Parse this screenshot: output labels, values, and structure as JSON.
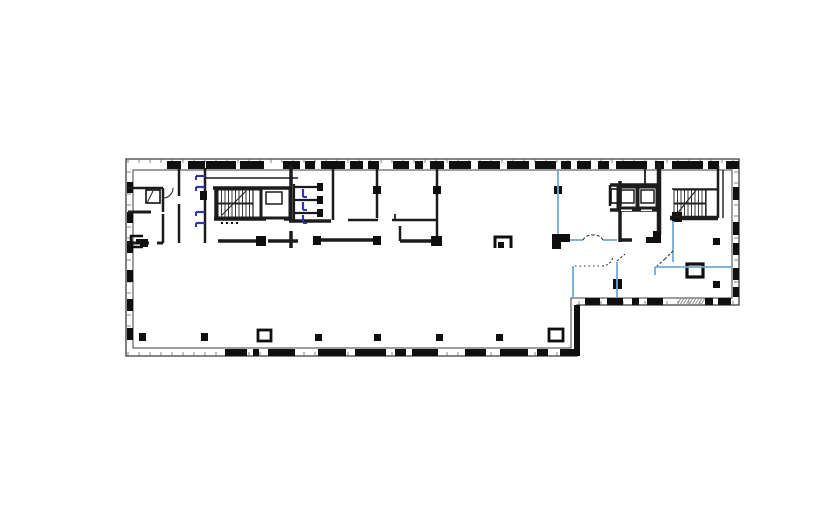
{
  "app": {
    "type": "cad-floor-plan-view",
    "visible_text": ""
  },
  "canvas": {
    "width": 821,
    "height": 528,
    "background": "#ffffff"
  },
  "colors": {
    "outline": "#3c3c3c",
    "wall": "#1c1c1c",
    "pier": "#0f0f0f",
    "tread": "#222222",
    "tick": "#666666",
    "hatch": "#8a8a8a",
    "partition_blue": "#74aad2",
    "door_blue": "#3434b2",
    "dash": "#333333",
    "white": "#ffffff"
  },
  "plan": {
    "perimeter": {
      "outer": "126,159 739,159 739,305 577,305 577,356 126,356",
      "inner": "133,170 732,170 732,298 571,298 571,348 133,348"
    },
    "step_wall": [
      574,
      305,
      6,
      51
    ],
    "wall_piers": {
      "top": {
        "y": 161,
        "h": 8,
        "spans": [
          [
            167,
            181
          ],
          [
            188,
            205
          ],
          [
            206,
            236
          ],
          [
            240,
            264
          ],
          [
            283,
            300
          ],
          [
            305,
            315
          ],
          [
            321,
            345
          ],
          [
            350,
            363
          ],
          [
            368,
            379
          ],
          [
            393,
            409
          ],
          [
            415,
            423
          ],
          [
            430,
            444
          ],
          [
            449,
            471
          ],
          [
            478,
            500
          ],
          [
            507,
            529
          ],
          [
            535,
            556
          ],
          [
            561,
            571
          ],
          [
            577,
            591
          ],
          [
            598,
            609
          ],
          [
            616,
            647
          ],
          [
            655,
            664
          ],
          [
            672,
            703
          ],
          [
            708,
            719
          ],
          [
            726,
            739
          ]
        ]
      },
      "bottom_left": {
        "y": 349,
        "h": 7,
        "spans": [
          [
            225,
            247
          ],
          [
            253,
            259
          ],
          [
            268,
            295
          ],
          [
            318,
            346
          ],
          [
            355,
            386
          ],
          [
            395,
            406
          ],
          [
            412,
            438
          ],
          [
            465,
            486
          ],
          [
            500,
            528
          ],
          [
            537,
            548
          ],
          [
            560,
            577
          ]
        ]
      },
      "bottom_right": {
        "y": 298,
        "h": 7,
        "spans": [
          [
            585,
            600
          ],
          [
            607,
            623
          ],
          [
            632,
            639
          ],
          [
            647,
            663
          ],
          [
            705,
            713
          ],
          [
            718,
            731
          ]
        ]
      },
      "left": {
        "x": 127,
        "w": 6,
        "spans": [
          [
            182,
            193
          ],
          [
            212,
            223
          ],
          [
            241,
            253
          ],
          [
            270,
            282
          ],
          [
            299,
            311
          ],
          [
            328,
            340
          ]
        ]
      },
      "right": {
        "x": 733,
        "w": 6,
        "spans": [
          [
            187,
            200
          ],
          [
            222,
            235
          ],
          [
            243,
            255
          ],
          [
            268,
            280
          ],
          [
            287,
            297
          ]
        ]
      }
    },
    "hatch_strip": {
      "x1": 677,
      "x2": 702,
      "y": 298,
      "h": 7
    },
    "walls": [
      [
        128,
        188,
        163,
        188,
        2.5
      ],
      [
        163,
        188,
        163,
        212,
        2.5
      ],
      [
        128,
        212,
        151,
        212,
        3
      ],
      [
        128,
        243,
        149,
        243,
        3
      ],
      [
        157,
        243,
        163,
        243,
        3
      ],
      [
        163,
        214,
        163,
        243,
        2.5
      ],
      [
        179,
        168,
        179,
        196,
        2.5
      ],
      [
        179,
        204,
        179,
        243,
        2.5
      ],
      [
        205,
        168,
        205,
        191,
        2.5
      ],
      [
        205,
        200,
        205,
        243,
        2.5
      ],
      [
        205,
        178,
        298,
        178,
        1.6
      ],
      [
        213,
        188,
        292,
        188,
        3.5
      ],
      [
        216,
        188,
        216,
        220,
        3.5
      ],
      [
        214,
        219,
        292,
        219,
        3.5
      ],
      [
        291,
        166,
        291,
        222,
        3.5
      ],
      [
        291,
        231,
        291,
        248,
        3.5
      ],
      [
        294,
        187,
        317,
        187,
        2.2
      ],
      [
        294,
        200,
        317,
        200,
        2.2
      ],
      [
        294,
        213,
        317,
        213,
        2.2
      ],
      [
        294,
        184,
        294,
        221,
        2.2
      ],
      [
        289,
        221,
        331,
        221,
        3.5
      ],
      [
        333,
        169,
        333,
        220,
        2.5
      ],
      [
        377,
        169,
        377,
        218,
        2.5
      ],
      [
        437,
        169,
        437,
        243,
        2.5
      ],
      [
        348,
        220,
        378,
        220,
        2.5
      ],
      [
        392,
        220,
        437,
        220,
        2.5
      ],
      [
        395,
        214,
        395,
        220,
        1.8
      ],
      [
        400,
        226,
        400,
        241,
        2.5
      ],
      [
        400,
        241,
        434,
        241,
        3.5
      ],
      [
        218,
        241,
        257,
        241,
        3.5
      ],
      [
        268,
        241,
        298,
        241,
        3.5
      ],
      [
        318,
        240,
        377,
        240,
        3.5
      ],
      [
        620,
        181,
        620,
        242,
        3.5
      ],
      [
        620,
        240,
        632,
        240,
        3.5
      ],
      [
        610,
        185,
        658,
        185,
        3.5
      ],
      [
        610,
        185,
        610,
        206,
        2.5
      ],
      [
        610,
        210,
        658,
        210,
        3.5
      ],
      [
        659,
        163,
        659,
        235,
        4.5
      ],
      [
        672,
        189,
        718,
        189,
        1.6
      ],
      [
        670,
        218,
        718,
        218,
        4.5
      ],
      [
        718,
        166,
        718,
        218,
        2.5
      ],
      [
        723,
        170,
        723,
        218,
        1.4
      ],
      [
        645,
        166,
        645,
        185,
        1.8
      ]
    ],
    "white_gaps": [
      [
        266,
        215,
        18,
        6
      ],
      [
        621,
        206,
        11,
        5
      ],
      [
        641,
        206,
        11,
        5
      ]
    ],
    "fills": [
      [
        200,
        191,
        7,
        9
      ],
      [
        317,
        183,
        6,
        8
      ],
      [
        317,
        196,
        6,
        8
      ],
      [
        317,
        209,
        6,
        8
      ],
      [
        373,
        186,
        8,
        8
      ],
      [
        433,
        186,
        8,
        8
      ],
      [
        431,
        236,
        11,
        10
      ],
      [
        554,
        186,
        8,
        8
      ],
      [
        256,
        236,
        10,
        10
      ],
      [
        313,
        236,
        8,
        9
      ],
      [
        373,
        236,
        8,
        9
      ],
      [
        552,
        234,
        18,
        8
      ],
      [
        552,
        242,
        9,
        7
      ],
      [
        653,
        231,
        8,
        12
      ],
      [
        646,
        237,
        8,
        6
      ],
      [
        672,
        212,
        10,
        10
      ],
      [
        613,
        279,
        9,
        10
      ],
      [
        140,
        239,
        8,
        8
      ],
      [
        139,
        333,
        7,
        8
      ],
      [
        201,
        333,
        7,
        8
      ],
      [
        315,
        334,
        7,
        7
      ],
      [
        374,
        334,
        7,
        7
      ],
      [
        436,
        334,
        7,
        7
      ],
      [
        496,
        334,
        7,
        7
      ],
      [
        713,
        238,
        7,
        7
      ],
      [
        713,
        281,
        7,
        7
      ]
    ],
    "hollow_rects": [
      {
        "r": [
          258,
          330,
          13,
          11
        ],
        "w": 2.8,
        "name": "column-wide-1"
      },
      {
        "r": [
          549,
          329,
          14,
          12
        ],
        "w": 2.8,
        "name": "column-wide-2"
      },
      {
        "r": [
          687,
          264,
          16,
          13
        ],
        "w": 3.2,
        "name": "shaft-box"
      },
      {
        "r": [
          146,
          190,
          14,
          13
        ],
        "w": 1.6,
        "name": "closet-box"
      },
      {
        "r": [
          611,
          189,
          7,
          14
        ],
        "w": 1.6,
        "name": "elevator-alcove-fixture"
      }
    ],
    "stroke_paths": [
      {
        "d": "M495,248 V237 H511 V248",
        "w": 3,
        "name": "column-bracket"
      },
      {
        "d": "M143,236 H131 V247 H143",
        "w": 2.5,
        "name": "fixture-bracket"
      }
    ],
    "bracket_fills": [
      [
        498,
        242,
        6,
        6
      ],
      [
        136,
        239,
        6,
        5
      ]
    ],
    "stairs": [
      {
        "x": 218,
        "y": 190,
        "w": 43,
        "h": 27,
        "landingW": 8,
        "step": 3.5,
        "diag": [
          222,
          215,
          246,
          191
        ],
        "name": "stair-left"
      },
      {
        "x": 674,
        "y": 190,
        "w": 44,
        "h": 27,
        "landingW": 12,
        "step": 3.5,
        "diag": [
          676,
          215,
          697,
          189
        ],
        "name": "stair-right"
      }
    ],
    "elevators": [
      {
        "shaft": [
          261,
          188,
          29,
          30
        ],
        "car": [
          266,
          192,
          16,
          12
        ],
        "name": "elevator-left"
      },
      {
        "shaft": [
          618,
          187,
          19,
          21
        ],
        "car": [
          621,
          190,
          13,
          13
        ],
        "name": "elevator-right-1"
      },
      {
        "shaft": [
          638,
          187,
          19,
          21
        ],
        "car": [
          641,
          190,
          13,
          13
        ],
        "name": "elevator-right-2"
      }
    ],
    "blue_partitions": [
      [
        558,
        170,
        558,
        234
      ],
      [
        570,
        240,
        583,
        240
      ],
      [
        603,
        240,
        617,
        240
      ],
      [
        673,
        221,
        673,
        262
      ],
      [
        655,
        267,
        732,
        267
      ],
      [
        655,
        267,
        655,
        275
      ],
      [
        573,
        266,
        573,
        299
      ],
      [
        617,
        262,
        617,
        298
      ]
    ],
    "blue_ticks": [
      {
        "x": 205,
        "y": 176,
        "o": "h"
      },
      {
        "x": 205,
        "y": 187,
        "o": "h"
      },
      {
        "x": 205,
        "y": 212,
        "o": "h"
      },
      {
        "x": 205,
        "y": 223,
        "o": "h"
      },
      {
        "x": 303,
        "y": 189,
        "o": "v"
      },
      {
        "x": 303,
        "y": 202,
        "o": "v"
      },
      {
        "x": 303,
        "y": 215,
        "o": "v"
      }
    ],
    "dashed_paths": [
      {
        "d": "M583,240 A10,10 0 0 1 593,235",
        "dash": "3,2",
        "name": "door-swing-lobby-a"
      },
      {
        "d": "M603,240 A10,10 0 0 0 593,235",
        "dash": "3,2",
        "name": "door-swing-lobby-b"
      },
      {
        "d": "M575,266 L602,266",
        "dash": "1.5,3",
        "name": "dotted-partition"
      },
      {
        "d": "M602,266 A11,11 0 0 0 613,256",
        "dash": "2,2",
        "name": "door-swing-partition"
      },
      {
        "d": "M673,251 L665,259 M665,259 L657,266",
        "dash": "2.5,2",
        "name": "door-leaf-dashed-a"
      },
      {
        "d": "M617,261 L625,254",
        "dash": "2.5,2",
        "name": "door-leaf-dashed-b"
      }
    ],
    "solid_arcs": [
      {
        "d": "M163,198 A10,10 0 0 0 173,188",
        "name": "door-swing-room"
      },
      {
        "d": "M147,203 L153,191",
        "name": "closet-door-leaf"
      }
    ],
    "stair_dots": [
      [
        221,
        222
      ],
      [
        226,
        222
      ],
      [
        231,
        222
      ],
      [
        236,
        222
      ]
    ],
    "tick_rows": {
      "top": {
        "axis": "x",
        "from": 128,
        "to": 736,
        "step": 11,
        "fixed": 159,
        "len": 4
      },
      "bottom_left": {
        "axis": "x",
        "from": 128,
        "to": 574,
        "step": 11,
        "fixed": 352,
        "len": 4
      },
      "bottom_right": {
        "axis": "x",
        "from": 579,
        "to": 736,
        "step": 11,
        "fixed": 301,
        "len": 4
      },
      "left": {
        "axis": "y",
        "from": 172,
        "to": 346,
        "step": 11,
        "fixed": 127,
        "len": 4
      },
      "right": {
        "axis": "y",
        "from": 172,
        "to": 296,
        "step": 11,
        "fixed": 734,
        "len": 4
      }
    }
  }
}
